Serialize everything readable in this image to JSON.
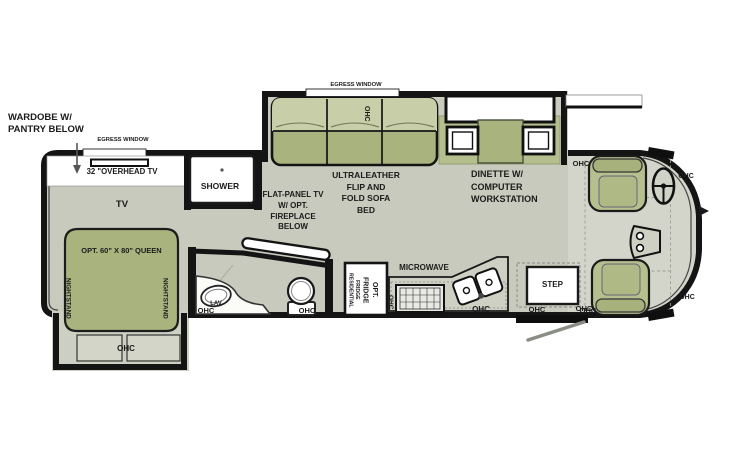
{
  "diagram_type": "rv-floorplan",
  "colors": {
    "floor": "#c7cabd",
    "slide_floor": "#ccd0c2",
    "cab_floor": "#d3d5ca",
    "furniture_green": "#a9b37e",
    "furniture_green_light": "#c7cea8",
    "bench_green": "#b5bf8e",
    "seat_green": "#b6c08f",
    "wall_black": "#141414",
    "white": "#ffffff",
    "text": "#1b1b1b"
  },
  "labels": {
    "wardrobe_callout": "WARDOBE W/\nPANTRY BELOW",
    "egress_window": "EGRESS WINDOW",
    "overhead_tv": "32 \"OVERHEAD TV",
    "tv": "TV",
    "queen_bed": "OPT. 60\" X 80\" QUEEN",
    "nightstand": "NIGHTSTAND",
    "ohc": "OHC",
    "shower": "SHOWER",
    "flat_panel_tv": "FLAT-PANEL TV\nW/ OPT.\nFIREPLACE\nBELOW",
    "lav": "LAV",
    "sofa_bed": "ULTRALEATHER\nFLIP AND\nFOLD SOFA\nBED",
    "dinette": "DINETTE W/\nCOMPUTER\nWORKSTATION",
    "residential_fridge": "RESIDENTIAL\nFRIDGE",
    "fridge_opt": "FRIDGE\nOPT.",
    "microwave": "MICROWAVE",
    "step": "STEP"
  }
}
